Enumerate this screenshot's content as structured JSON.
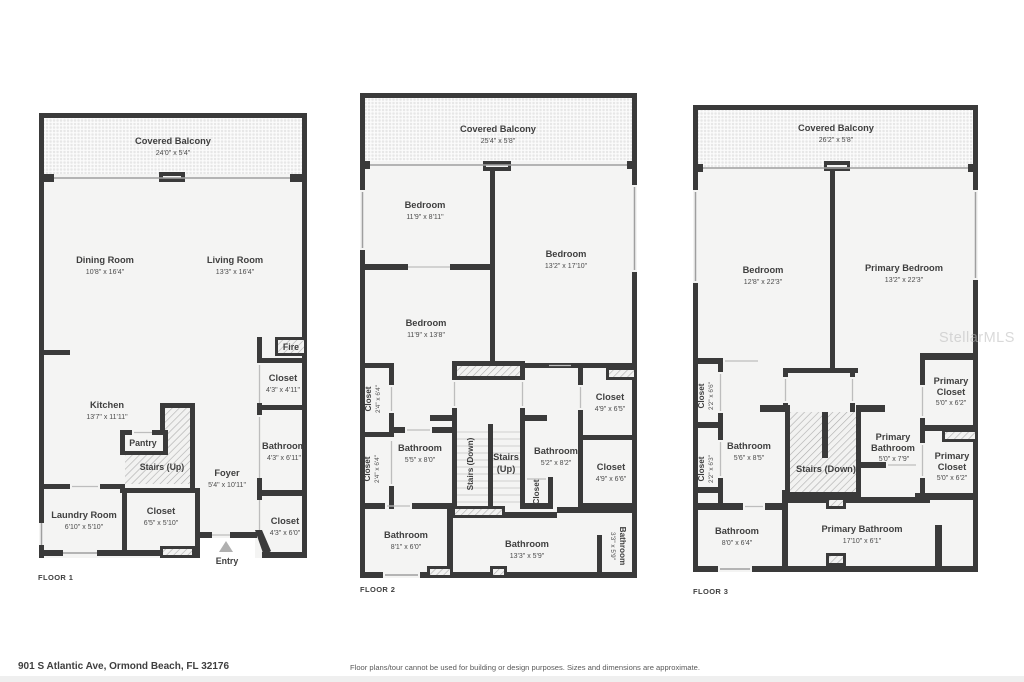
{
  "watermark": "StellarMLS",
  "footer": {
    "address": "901 S Atlantic Ave, Ormond Beach, FL 32176",
    "disclaimer": "Floor plans/tour cannot be used for building or design purposes. Sizes and dimensions are approximate."
  },
  "colors": {
    "wall": "#3a3a3a",
    "floor_fill": "#f4f4f3",
    "text": "#3f3f3f",
    "hatch": "#adadad"
  },
  "floors": [
    {
      "label": "FLOOR 1",
      "rooms": [
        {
          "name": "Covered Balcony",
          "dims": "24'0\" x 5'4\""
        },
        {
          "name": "Dining Room",
          "dims": "10'8\" x 16'4\""
        },
        {
          "name": "Living Room",
          "dims": "13'3\" x 16'4\""
        },
        {
          "name": "Kitchen",
          "dims": "13'7\" x 11'11\""
        },
        {
          "name": "Pantry"
        },
        {
          "name": "Stairs (Up)"
        },
        {
          "name": "Foyer",
          "dims": "5'4\" x 10'11\""
        },
        {
          "name": "Laundry Room",
          "dims": "6'10\" x 5'10\""
        },
        {
          "name": "Closet",
          "dims": "6'5\" x 5'10\""
        },
        {
          "name": "Fire"
        },
        {
          "name": "Closet",
          "dims": "4'3\" x 4'11\""
        },
        {
          "name": "Bathroom",
          "dims": "4'3\" x 6'11\""
        },
        {
          "name": "Closet",
          "dims": "4'3\" x 6'0\""
        },
        {
          "name": "Entry"
        }
      ]
    },
    {
      "label": "FLOOR 2",
      "rooms": [
        {
          "name": "Covered Balcony",
          "dims": "25'4\" x 5'8\""
        },
        {
          "name": "Bedroom",
          "dims": "11'9\" x 8'11\""
        },
        {
          "name": "Bedroom",
          "dims": "13'2\" x 17'10\""
        },
        {
          "name": "Bedroom",
          "dims": "11'9\" x 13'8\""
        },
        {
          "name": "Closet",
          "dims": "2'4\" x 6'4\""
        },
        {
          "name": "Closet",
          "dims": "2'4\" x 6'4\""
        },
        {
          "name": "Bathroom",
          "dims": "5'5\" x 8'0\""
        },
        {
          "name": "Stairs (Down)"
        },
        {
          "name": "Stairs",
          "name2": "(Up)"
        },
        {
          "name": "Bathroom",
          "dims": "5'2\" x 8'2\""
        },
        {
          "name": "Closet"
        },
        {
          "name": "Closet",
          "dims": "4'9\" x 6'5\""
        },
        {
          "name": "Closet",
          "dims": "4'9\" x 6'6\""
        },
        {
          "name": "Bathroom",
          "dims": "8'1\" x 6'0\""
        },
        {
          "name": "Bathroom",
          "dims": "13'3\" x 5'9\""
        },
        {
          "name": "Bathroom",
          "dims": "3'3\" x 5'9\""
        }
      ]
    },
    {
      "label": "FLOOR 3",
      "rooms": [
        {
          "name": "Covered Balcony",
          "dims": "26'2\" x 5'8\""
        },
        {
          "name": "Bedroom",
          "dims": "12'8\" x 22'3\""
        },
        {
          "name": "Primary Bedroom",
          "dims": "13'2\" x 22'3\""
        },
        {
          "name": "Closet",
          "dims": "2'2\" x 6'6\""
        },
        {
          "name": "Closet",
          "dims": "2'2\" x 6'3\""
        },
        {
          "name": "Bathroom",
          "dims": "5'6\" x 8'5\""
        },
        {
          "name": "Stairs (Down)"
        },
        {
          "name": "Primary",
          "name2": "Bathroom",
          "dims": "5'0\" x 7'9\""
        },
        {
          "name": "Primary",
          "name2": "Closet",
          "dims": "5'0\" x 6'2\""
        },
        {
          "name": "Primary",
          "name2": "Closet",
          "dims": "5'0\" x 6'2\""
        },
        {
          "name": "Bathroom",
          "dims": "8'0\" x 6'4\""
        },
        {
          "name": "Primary Bathroom",
          "dims": "17'10\" x 6'1\""
        }
      ]
    }
  ]
}
